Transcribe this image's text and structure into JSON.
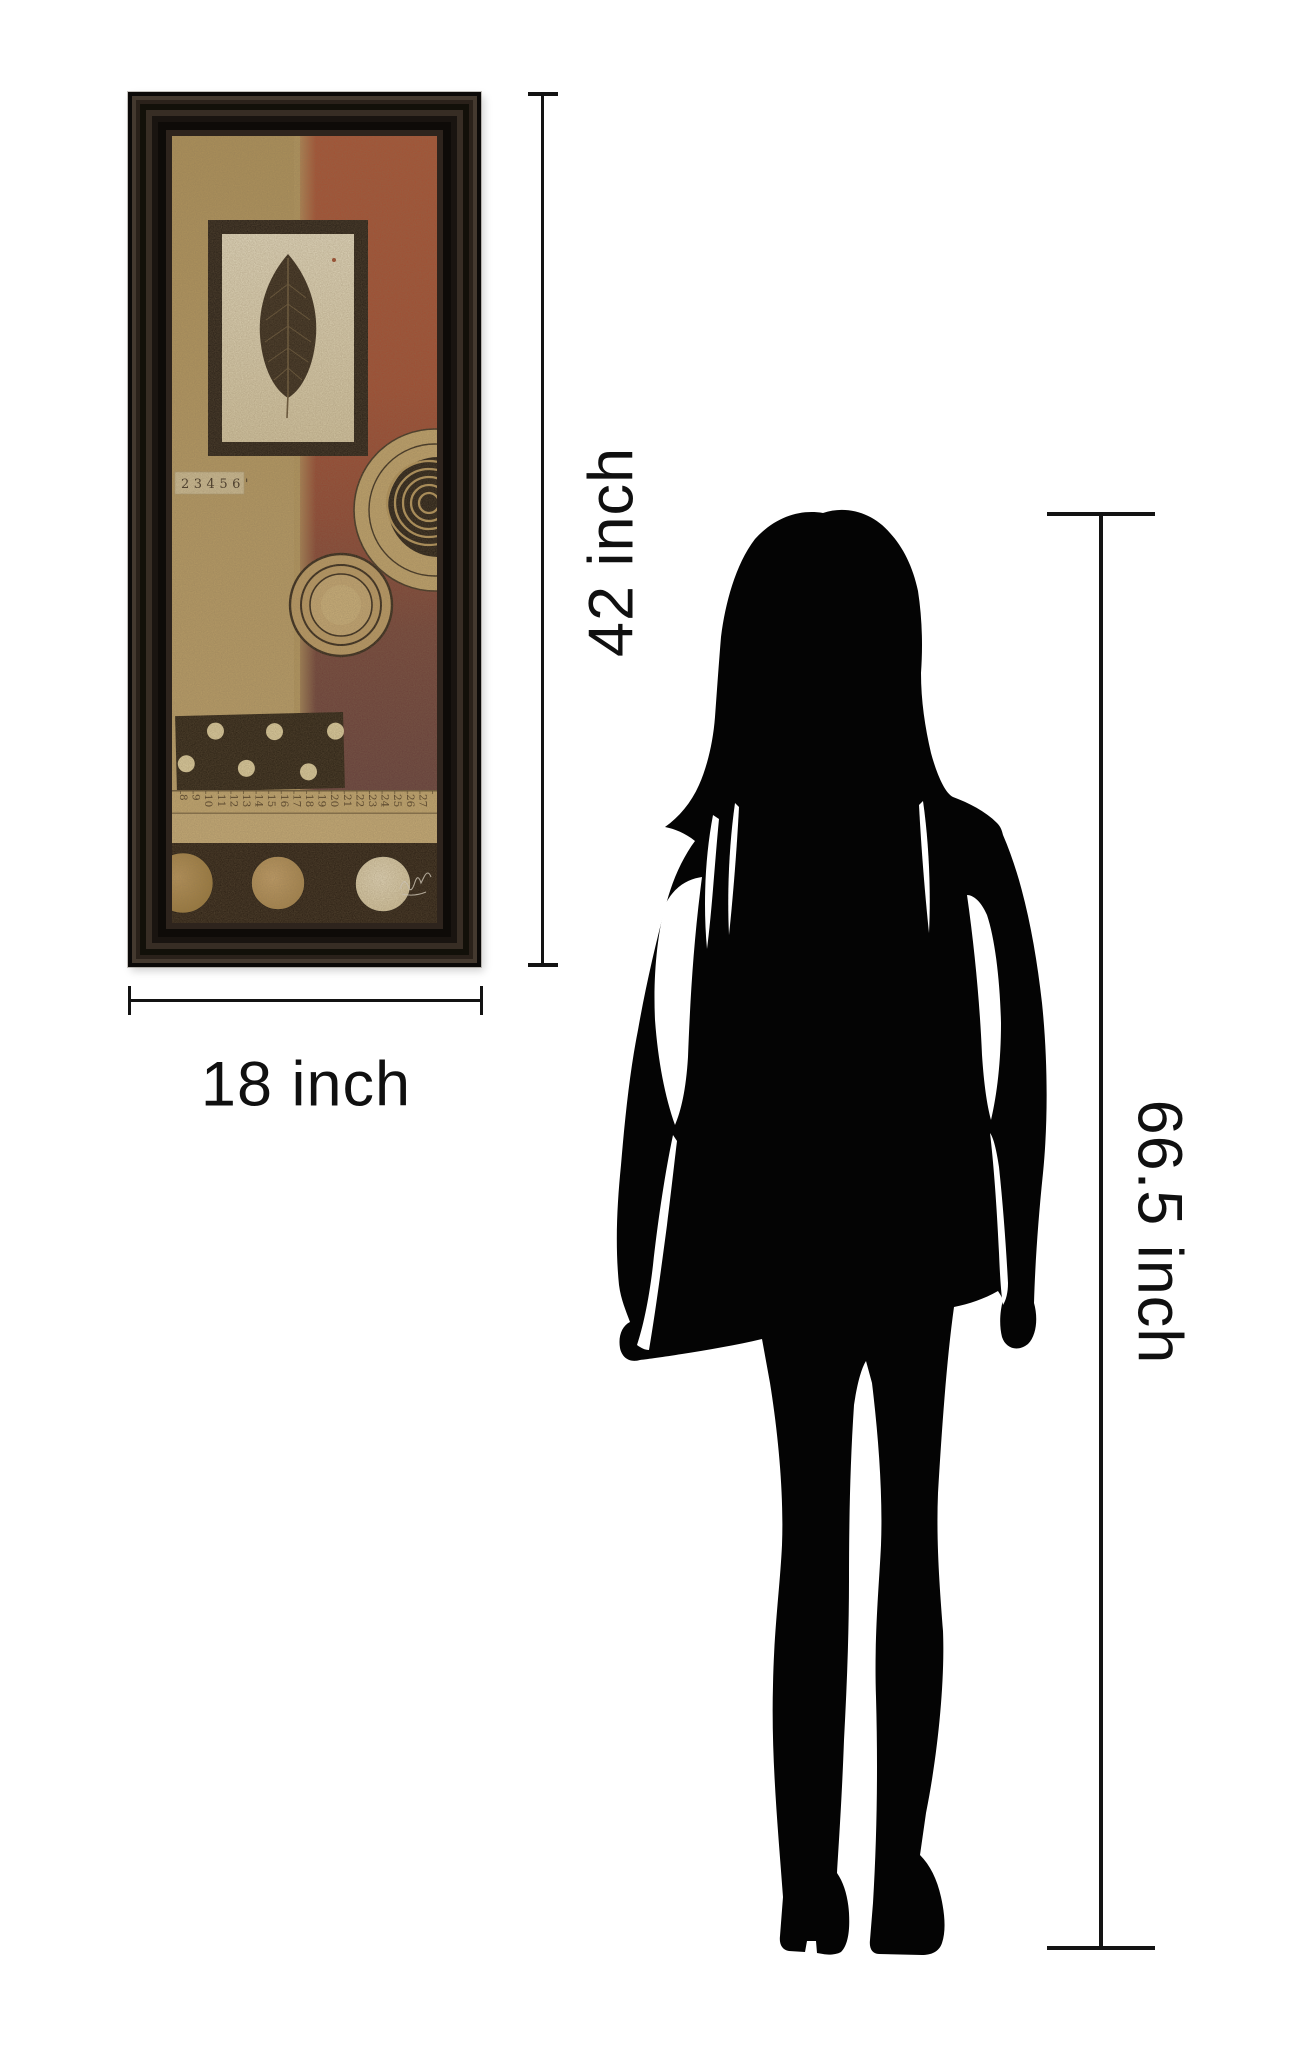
{
  "canvas": {
    "background": "#ffffff"
  },
  "art": {
    "collage_label": "23456'",
    "ruler_numbers": [
      "8",
      "9",
      "10",
      "11",
      "12",
      "13",
      "14",
      "15",
      "16",
      "17",
      "18",
      "19",
      "20",
      "21",
      "22",
      "23",
      "24",
      "25",
      "26",
      "27"
    ],
    "colors": {
      "frame": "#241c15",
      "tan": "#b99d62",
      "red": "#a8492e",
      "maroon": "#5d3436",
      "cream_panel": "#e9e1c4",
      "black_elements": "#1a1208"
    }
  },
  "dimension_labels": {
    "art_height": "42 inch",
    "art_width": "18 inch",
    "person_height": "66.5 inch"
  },
  "silhouette": {
    "color": "#040404",
    "subject": "standing-woman"
  },
  "line_color": "#131313"
}
